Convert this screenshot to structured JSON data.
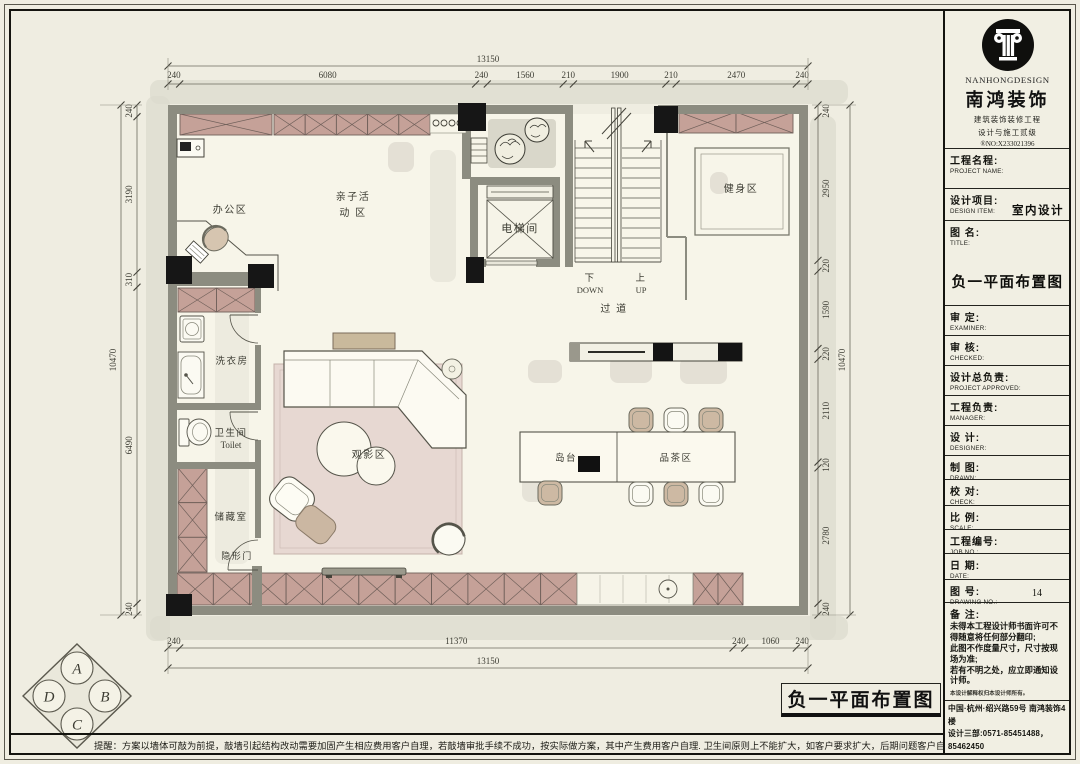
{
  "colors": {
    "paper": "#efede1",
    "floor": "#f7f5e9",
    "wall": "#8c8c80",
    "column": "#161616",
    "cabinet_pink": "#c5a198",
    "rug_pink": "#e7d8d2",
    "furniture_tan": "#cdb9a3"
  },
  "plan": {
    "caption": "负一平面布置图",
    "rooms": {
      "office": "办公区",
      "family_line1": "亲子活",
      "family_line2": "动  区",
      "elevator": "电梯间",
      "gym": "健身区",
      "corridor": "过 道",
      "laundry": "洗衣房",
      "toilet_cn": "卫生间",
      "toilet_en": "Toilet",
      "storage": "储藏室",
      "hidden_door": "隐形门",
      "cinema": "观影区",
      "island": "岛台",
      "tea": "品茶区",
      "down_cn": "下",
      "down_en": "DOWN",
      "up_cn": "上",
      "up_en": "UP"
    }
  },
  "dimensions": {
    "top": {
      "total": 13150,
      "segments": [
        240,
        6080,
        240,
        1560,
        210,
        1900,
        210,
        2470,
        240
      ]
    },
    "bottom": {
      "total": 13150,
      "segments": [
        240,
        11370,
        240,
        1060,
        240
      ]
    },
    "left": {
      "total": 10470,
      "segments": [
        240,
        3190,
        310,
        6490,
        240
      ]
    },
    "right": {
      "total": 10470,
      "segments": [
        240,
        2950,
        220,
        1590,
        220,
        2110,
        120,
        2780,
        240
      ]
    }
  },
  "compass": {
    "letters": [
      "A",
      "B",
      "C",
      "D"
    ]
  },
  "title_block": {
    "logo": {
      "en": "NANHONGDESIGN",
      "cn": "南鸿装饰",
      "sub1": "建筑装饰装修工程",
      "sub2": "设计与施工贰级",
      "cert_no": "®NO:X233021396"
    },
    "rows": [
      {
        "cn": "工程名程:",
        "en": "PROJECT NAME:"
      },
      {
        "cn": "设计项目:",
        "en": "DESIGN ITEM:",
        "value": "室内设计"
      },
      {
        "cn": "图  名:",
        "en": "TITLE:",
        "value": "负一平面布置图"
      },
      {
        "cn": "审  定:",
        "en": "EXAMINER:"
      },
      {
        "cn": "审  核:",
        "en": "CHECKED:"
      },
      {
        "cn": "设计总负责:",
        "en": "PROJECT APPROVED:"
      },
      {
        "cn": "工程负责:",
        "en": "MANAGER:"
      },
      {
        "cn": "设  计:",
        "en": "DESIGNER:"
      },
      {
        "cn": "制  图:",
        "en": "DRAWN:"
      },
      {
        "cn": "校  对:",
        "en": "CHECK:"
      },
      {
        "cn": "比  例:",
        "en": "SCALE:"
      },
      {
        "cn": "工程编号:",
        "en": "JOB NO.:"
      },
      {
        "cn": "日  期:",
        "en": "DATE:"
      },
      {
        "cn": "图  号:",
        "en": "DRAWING NO.:",
        "value": "14"
      }
    ],
    "remark": {
      "label": "备  注:",
      "lines": [
        "未得本工程设计师书面许可不得随意将任何部分翻印;",
        "此图不作度量尺寸，尺寸按现场为准;",
        "若有不明之处，应立即通知设计师。"
      ],
      "fine": "本设计解释权归本设计师所有。"
    },
    "address": {
      "line1": "中国·杭州·绍兴路59号 南鸿装饰4楼",
      "line2": "设计三部:0571-85451488，85462450"
    }
  },
  "footer": {
    "note": "提醒：方案以墙体可敲为前提，敲墙引起结构改动需要加固产生相应费用客户自理，若敲墙审批手续不成功，按实际做方案，其中产生费用客户自理. 卫生间原则上不能扩大，如客户要求扩大，后期问题客户自己承担责任."
  }
}
